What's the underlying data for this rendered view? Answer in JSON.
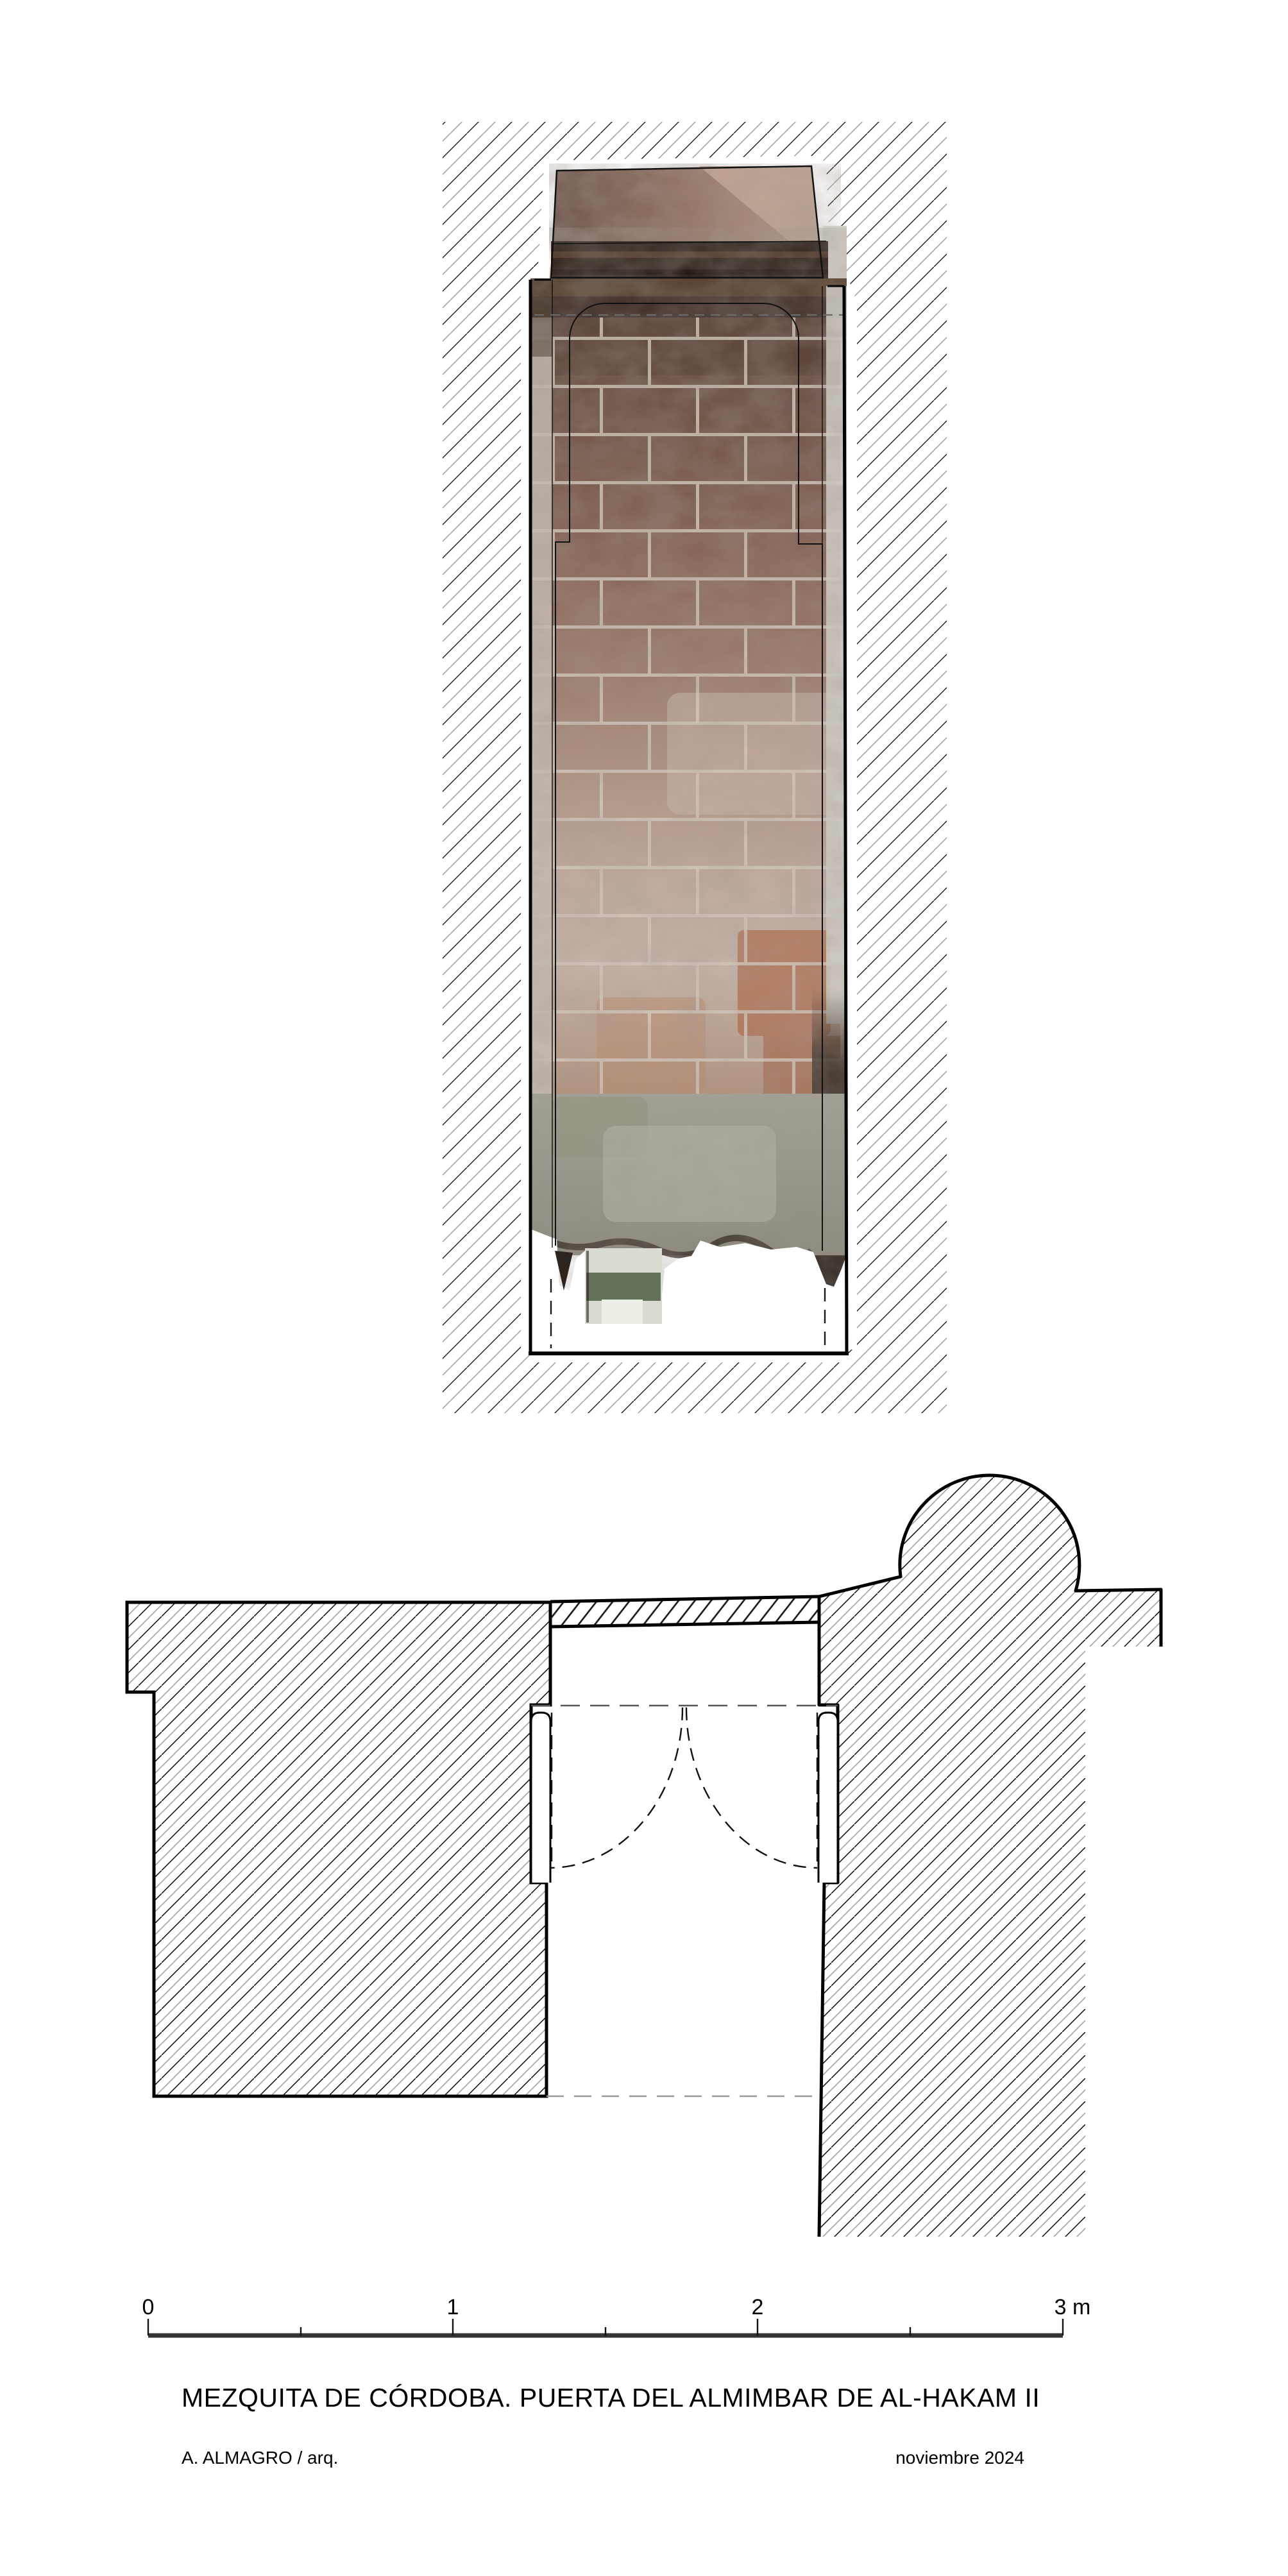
{
  "sheet": {
    "title": "MEZQUITA DE CÓRDOBA. PUERTA DEL ALMIMBAR DE AL-HAKAM II",
    "author": "A. ALMAGRO / arq.",
    "date": "noviembre 2024"
  },
  "scale_bar": {
    "labels": [
      "0",
      "1",
      "2",
      "3 m"
    ],
    "total_meters": 3
  },
  "colors": {
    "paper": "#ffffff",
    "line": "#000000",
    "hatch_dark": "#1c1c1c",
    "hatch_gray": "#8a8a8a",
    "wood": "#2e221b",
    "wood_streak": "#5f4233",
    "shadow_band": "#55402f",
    "shadow_dark": "#3a2c24",
    "brick_dark": "#6b4f43",
    "brick_mid": "#9e7e6f",
    "brick_light": "#c6b2a6",
    "brick_orange": "#b06a48",
    "mortar": "#d9cec3",
    "lintel_dark": "#6b5148",
    "lintel_light": "#b39484",
    "lintel_corner": "#c4a895",
    "jamb_left": "#c9c0b6",
    "jamb_right": "#d3d0ca",
    "streak_dark": "#241e18",
    "concrete": "#97968a",
    "concrete_light": "#b8b5a8",
    "concrete_green": "#8d9078",
    "stub": "#d9dad0",
    "stub_green": "#55644d",
    "dashed_gray": "#8c8c8c"
  }
}
